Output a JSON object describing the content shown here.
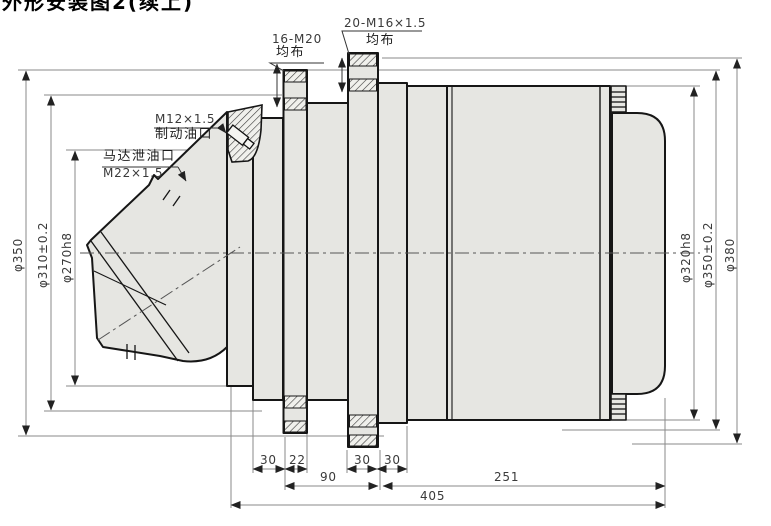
{
  "title_partial": "外形安装图2(续上)",
  "ports": {
    "brake": {
      "thread": "M12×1.5",
      "name": "制动油口"
    },
    "drain": {
      "name": "马达泄油口",
      "thread": "M22×1.5"
    }
  },
  "flanges": {
    "front": {
      "holes": "16-M20",
      "note": "均布"
    },
    "rear": {
      "holes": "20-M16×1.5",
      "note": "均布"
    }
  },
  "diameters_left": [
    "φ350",
    "φ310±0.2",
    "φ270h8"
  ],
  "diameters_right": [
    "φ320h8",
    "φ350±0.2",
    "φ380"
  ],
  "lengths_row1": [
    "30",
    "22",
    "30",
    "30"
  ],
  "lengths_row2": [
    "90",
    "251"
  ],
  "length_overall": "405",
  "colors": {
    "part_fill": "#e6e6e2",
    "outline": "#161616",
    "dimension_line": "#8a8a8a",
    "hatch": "#3a3a3a",
    "background": "#ffffff"
  }
}
